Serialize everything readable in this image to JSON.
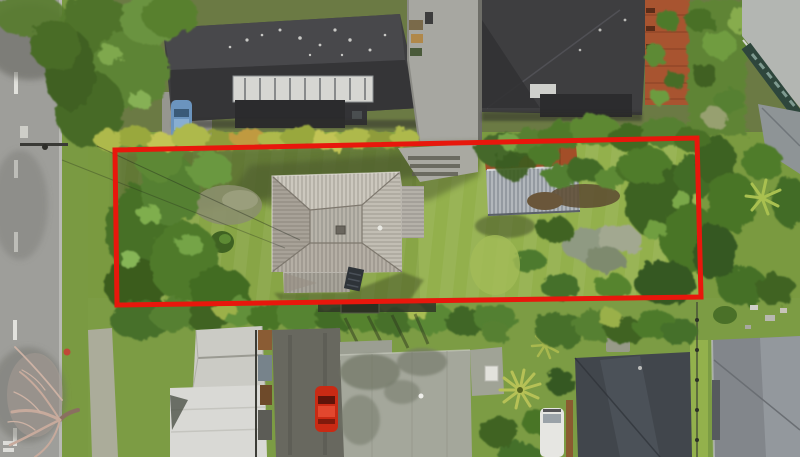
{
  "meta": {
    "image_type": "aerial-photograph",
    "scene": "Top-down drone photo of a suburban residential block; the marketed section is outlined with a red rectangle",
    "width_px": 800,
    "height_px": 457
  },
  "boundary": {
    "label": "property-boundary-outline",
    "color": "#e8170c",
    "stroke_px": 5,
    "points": "115,150 697,138 701,297 117,305"
  },
  "palette": {
    "road_asphalt": "#9e9e9a",
    "road_marking": "#e9e9e4",
    "lawn": "#88a546",
    "lawn_bright": "#93b04c",
    "foliage_dark": "#3e6222",
    "foliage_mid": "#4f7a2a",
    "foliage_light": "#6f9e40",
    "hedge_yellow_green": "#aeb94b",
    "roof_dark_charcoal": "#3e3e40",
    "roof_main_gray": "#b9b5ad",
    "roof_shed_metal": "#b2b7bc",
    "shed_rust": "#a34e28",
    "deck_terracotta": "#a85430",
    "roof_white": "#d9d9d5",
    "roof_gable_white": "#cbcbc5",
    "roof_sage": "#a4a79b",
    "roof_slate": "#41464c",
    "roof_neighbour_gray": "#82868b",
    "car_red": "#c92a14",
    "car_blue": "#6b94be",
    "van_white": "#e6e6e2",
    "tree_bare_branches": "#c7aa9c",
    "shadow_green": "#3d4d28",
    "driveway_concrete": "#a7a7a1",
    "driveway_dark": "#68685f"
  },
  "features": {
    "street": "vertical two-lane road on the left with white dashed centreline and kerb",
    "power_line": "power crossarm and wires crossing the street near the boundary's top-left corner",
    "subject_house": "grey cross-hipped ribbed-metal roof house inside the boundary",
    "subject_shed": "corrugated-metal shed with rusted upper band in the back yard",
    "blue_item": "small blue object on the front lawn",
    "neighbour_top_left": "large charcoal hip roof with white skylight strip and parked blue car",
    "neighbour_top_right": "charcoal hip roof beside shared concrete driveway, terracotta deck and glass-walled building at far right",
    "hedge": "yellow-green trimmed hedge row along the top boundary",
    "bottom_left_house": "white/pale roof house with gabled wing",
    "bottom_centre_house": "sage-grey roof house with tree shadows, red car on dark driveway",
    "bottom_right_houses": "dark slate roof house with white van, plus grey roof house at lower right",
    "bare_tree": "leafless pinkish tree overhanging the road at lower left",
    "palms": "yucca/palm rosettes in the lower-centre garden"
  }
}
